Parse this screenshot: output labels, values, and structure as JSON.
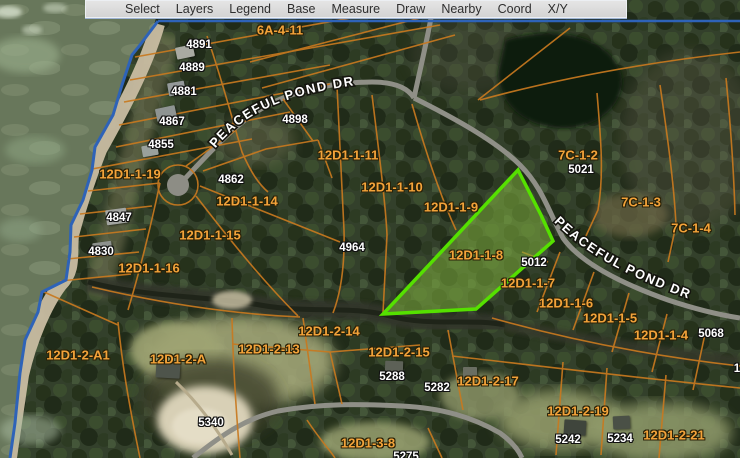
{
  "toolbar": {
    "items": [
      {
        "id": "select",
        "label": "Select"
      },
      {
        "id": "layers",
        "label": "Layers"
      },
      {
        "id": "legend",
        "label": "Legend"
      },
      {
        "id": "base",
        "label": "Base"
      },
      {
        "id": "measure",
        "label": "Measure"
      },
      {
        "id": "draw",
        "label": "Draw"
      },
      {
        "id": "nearby",
        "label": "Nearby"
      },
      {
        "id": "coord",
        "label": "Coord"
      },
      {
        "id": "xy",
        "label": "X/Y"
      }
    ]
  },
  "map": {
    "highlight_parcel": {
      "id": "12D1-1-8",
      "stroke_color": "#55e000",
      "fill_color": "#7fae3f"
    },
    "road_labels": [
      {
        "name": "peaceful-pond-dr-west",
        "text": "PEACEFUL POND DR"
      },
      {
        "name": "peaceful-pond-dr-east",
        "text": "PEACEFUL POND DR"
      }
    ],
    "parcel_labels": [
      {
        "text": "6A-4-11",
        "x": 280,
        "y": 30
      },
      {
        "text": "12D1-1-19",
        "x": 130,
        "y": 174
      },
      {
        "text": "12D1-1-14",
        "x": 247,
        "y": 201
      },
      {
        "text": "12D1-1-15",
        "x": 210,
        "y": 235
      },
      {
        "text": "12D1-1-16",
        "x": 149,
        "y": 268
      },
      {
        "text": "12D1-1-11",
        "x": 348,
        "y": 155
      },
      {
        "text": "12D1-1-10",
        "x": 392,
        "y": 187
      },
      {
        "text": "12D1-1-9",
        "x": 451,
        "y": 207
      },
      {
        "text": "12D1-1-8",
        "x": 476,
        "y": 255
      },
      {
        "text": "12D1-1-7",
        "x": 528,
        "y": 283
      },
      {
        "text": "12D1-1-6",
        "x": 566,
        "y": 303
      },
      {
        "text": "12D1-1-5",
        "x": 610,
        "y": 318
      },
      {
        "text": "12D1-1-4",
        "x": 661,
        "y": 335
      },
      {
        "text": "7C-1-2",
        "x": 578,
        "y": 155
      },
      {
        "text": "7C-1-3",
        "x": 641,
        "y": 202
      },
      {
        "text": "7C-1-4",
        "x": 691,
        "y": 228
      },
      {
        "text": "12D1-2-A1",
        "x": 78,
        "y": 355
      },
      {
        "text": "12D1-2-A",
        "x": 178,
        "y": 359
      },
      {
        "text": "12D1-2-13",
        "x": 269,
        "y": 349
      },
      {
        "text": "12D1-2-14",
        "x": 329,
        "y": 331
      },
      {
        "text": "12D1-2-15",
        "x": 399,
        "y": 352
      },
      {
        "text": "12D1-2-17",
        "x": 488,
        "y": 381
      },
      {
        "text": "12D1-2-19",
        "x": 578,
        "y": 411
      },
      {
        "text": "12D1-2-21",
        "x": 674,
        "y": 435
      },
      {
        "text": "12D1-3-8",
        "x": 368,
        "y": 443
      }
    ],
    "address_labels": [
      {
        "text": "4891",
        "x": 199,
        "y": 45
      },
      {
        "text": "4889",
        "x": 192,
        "y": 68
      },
      {
        "text": "4881",
        "x": 184,
        "y": 92
      },
      {
        "text": "4867",
        "x": 172,
        "y": 122
      },
      {
        "text": "4855",
        "x": 161,
        "y": 145
      },
      {
        "text": "4898",
        "x": 295,
        "y": 120
      },
      {
        "text": "4862",
        "x": 231,
        "y": 180
      },
      {
        "text": "4847",
        "x": 119,
        "y": 218
      },
      {
        "text": "4830",
        "x": 101,
        "y": 252
      },
      {
        "text": "4964",
        "x": 352,
        "y": 248
      },
      {
        "text": "5021",
        "x": 581,
        "y": 170
      },
      {
        "text": "5012",
        "x": 534,
        "y": 263
      },
      {
        "text": "5068",
        "x": 711,
        "y": 334
      },
      {
        "text": "5288",
        "x": 392,
        "y": 377
      },
      {
        "text": "5282",
        "x": 437,
        "y": 388
      },
      {
        "text": "5340",
        "x": 211,
        "y": 423
      },
      {
        "text": "5242",
        "x": 568,
        "y": 440
      },
      {
        "text": "5234",
        "x": 620,
        "y": 439
      },
      {
        "text": "5275",
        "x": 406,
        "y": 457
      },
      {
        "text": "1",
        "x": 737,
        "y": 369
      }
    ],
    "houses": [
      {
        "x": 185,
        "y": 52,
        "w": 18,
        "h": 12,
        "rot": -12,
        "c": "#a9aaa2"
      },
      {
        "x": 176,
        "y": 88,
        "w": 17,
        "h": 13,
        "rot": -10,
        "c": "#94999a"
      },
      {
        "x": 166,
        "y": 113,
        "w": 20,
        "h": 13,
        "rot": -12,
        "c": "#8e9492"
      },
      {
        "x": 150,
        "y": 150,
        "w": 16,
        "h": 11,
        "rot": -10,
        "c": "#9aa09c"
      },
      {
        "x": 116,
        "y": 216,
        "w": 21,
        "h": 15,
        "rot": -8,
        "c": "#a2a4a0"
      },
      {
        "x": 102,
        "y": 248,
        "w": 19,
        "h": 13,
        "rot": -8,
        "c": "#8d918d"
      },
      {
        "x": 168,
        "y": 370,
        "w": 24,
        "h": 16,
        "rot": 3,
        "c": "#4e544b"
      },
      {
        "x": 394,
        "y": 368,
        "w": 18,
        "h": 14,
        "rot": 2,
        "c": "#5d6157"
      },
      {
        "x": 470,
        "y": 372,
        "w": 14,
        "h": 10,
        "rot": 0,
        "c": "#6a6e62"
      },
      {
        "x": 575,
        "y": 427,
        "w": 22,
        "h": 15,
        "rot": 4,
        "c": "#3f453c"
      },
      {
        "x": 621,
        "y": 422,
        "w": 17,
        "h": 13,
        "rot": -3,
        "c": "#4a5046"
      }
    ],
    "colors": {
      "parcel_line": "#c8791f",
      "parcel_label": "#f3a33a",
      "address_label": "#ffffff",
      "water_boundary_blue": "#2e63b8",
      "road_gray": "#8f8f87",
      "toolbar_bg": "#d8d8d8"
    }
  }
}
